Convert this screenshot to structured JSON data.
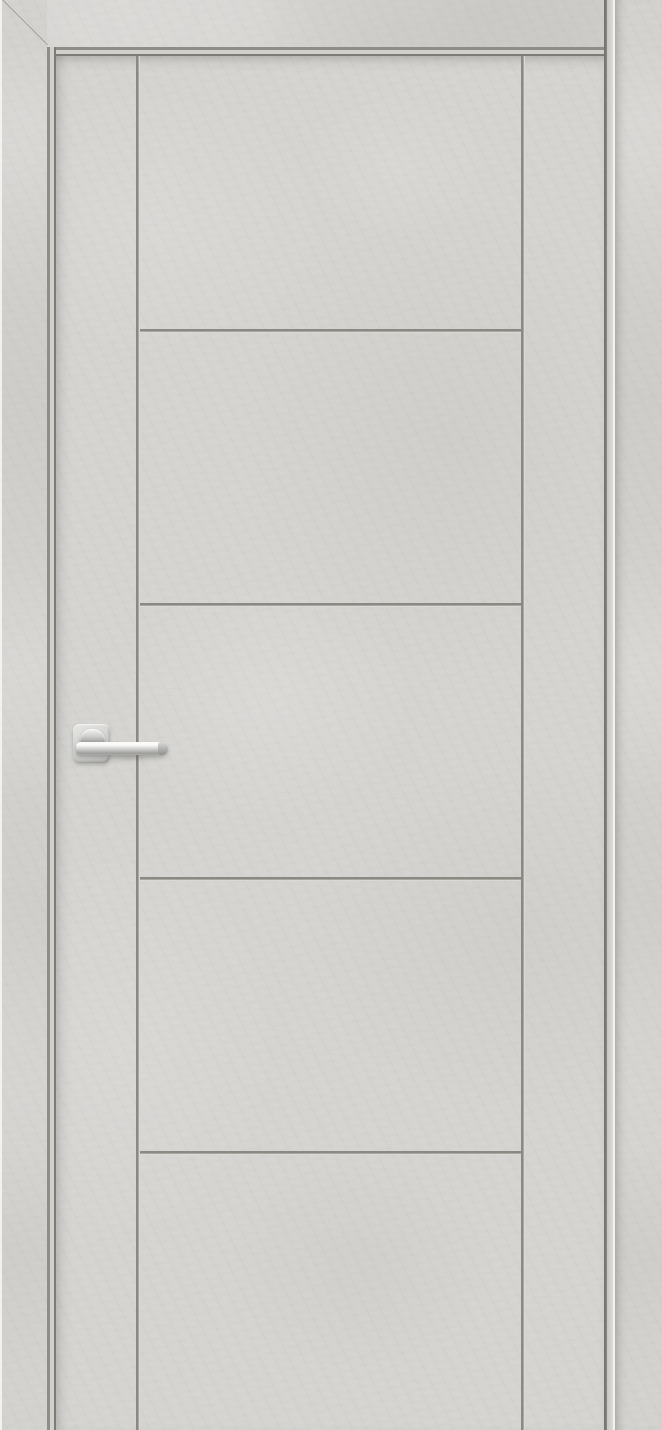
{
  "scene": {
    "type": "product-photo",
    "subject": "Interior door with light grey concrete-look finish, closed, front view",
    "finish": "light grey loft concrete / plaster texture",
    "text_visible": "none"
  },
  "door": {
    "leaf": {
      "style": "flush leaf with milled V-grooves",
      "vertical_grooves": 2,
      "horizontal_grooves": 4,
      "panel_count": 5,
      "groove_layout": "two full-height vertical grooves; four horizontal grooves between them dividing the centre field into five equal panels"
    },
    "frame": {
      "left_casing": "flat architrave, full height",
      "head_casing": "flat architrave across top",
      "right_casing": "flat architrave, full height",
      "top_left_joint": "45-degree miter",
      "reveal": "stepped jamb reveal with shadow gap around leaf"
    }
  },
  "handle": {
    "type": "lever handle on square rosette",
    "finish": "satin chrome",
    "rosette_shape": "square with rounded corners",
    "lever_direction": "pointing right",
    "position": "left edge of leaf, mid-height"
  },
  "colors": {
    "surface_base": "#d5d4d1",
    "casing_base": "#d3d2cf",
    "groove_dark": "#8b8983",
    "groove_highlight": "#dad9d5",
    "jamb_line_dark": "#7e7c77",
    "jamb_strip": "#d1d0cb",
    "edge_highlight": "#f3f2ef",
    "leaf_gap_shadow": "#6f6d69",
    "handle_chrome_light": "#fbfbfa",
    "handle_chrome_dark": "#8e8e8d"
  }
}
